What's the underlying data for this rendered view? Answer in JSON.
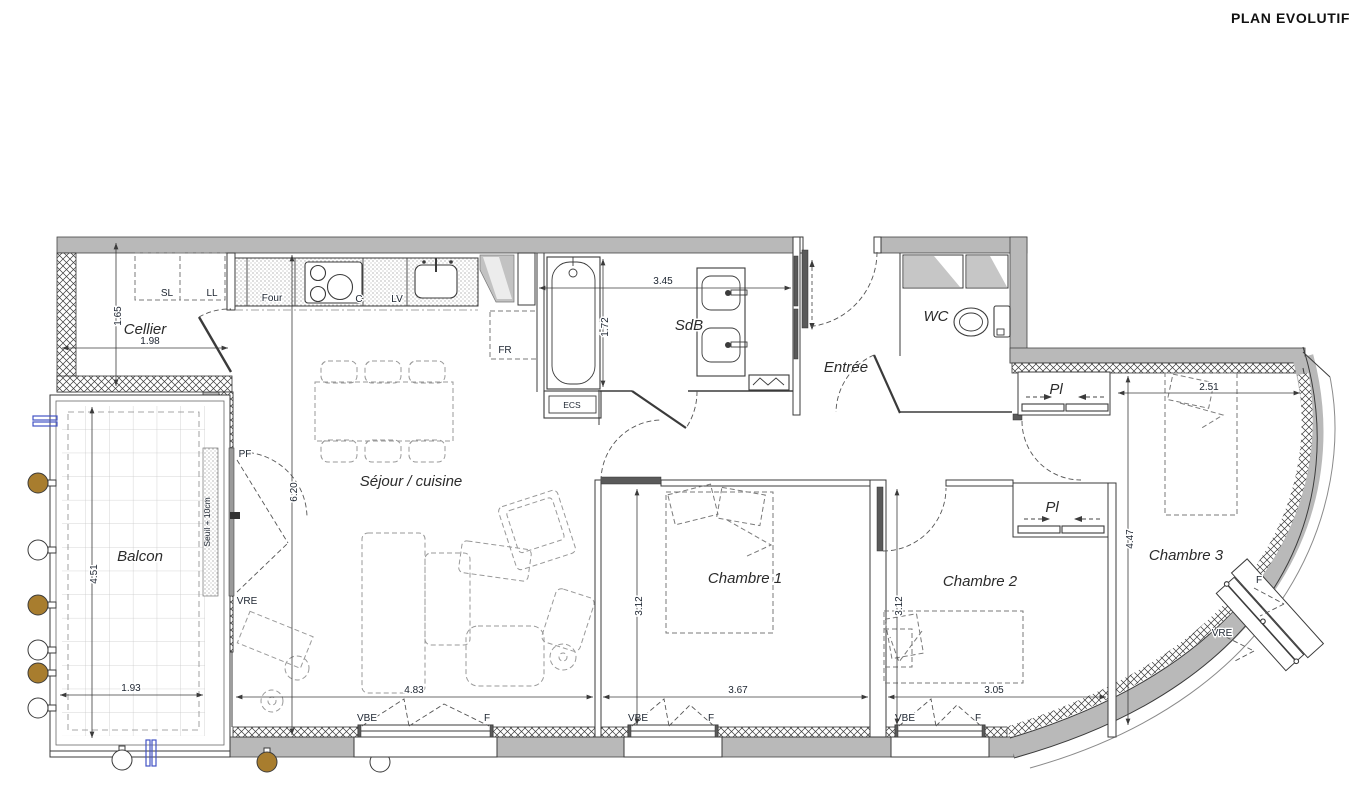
{
  "title": "PLAN EVOLUTIF",
  "rooms": {
    "cellier": "Cellier",
    "sejour": "Séjour / cuisine",
    "sdb": "SdB",
    "entree": "Entrée",
    "wc": "WC",
    "balcon": "Balcon",
    "chambre1": "Chambre 1",
    "chambre2": "Chambre 2",
    "chambre3": "Chambre 3",
    "placard": "Pl"
  },
  "equipment": {
    "sl": "SL",
    "ll": "LL",
    "four": "Four",
    "cuisson": "C",
    "lave_vaisselle": "LV",
    "frigo": "FR",
    "ecs": "ECS"
  },
  "openings": {
    "pf": "PF",
    "vre": "VRE",
    "vbe": "VBE",
    "fenetre": "F",
    "seuil": "Seuil + 10cm"
  },
  "dimensions": {
    "cellier_l": "1.98",
    "cellier_h": "1.65",
    "sdb_l": "3.45",
    "sdb_h": "1.72",
    "sejour_h": "6.20",
    "sejour_l": "4.83",
    "balcon_h": "4.51",
    "balcon_l": "1.93",
    "ch1_l": "3.67",
    "ch1_h": "3.12",
    "ch2_l": "3.05",
    "ch2_h": "3.12",
    "ch3_l": "2.51",
    "ch3_h": "4.47"
  },
  "colors": {
    "wall": "#b9b9b9",
    "line": "#3b3b3b",
    "dim_text": "#1c2430",
    "furniture": "#999999",
    "post_brown": "#a87d2e",
    "pipe_blue": "#4353c4"
  }
}
